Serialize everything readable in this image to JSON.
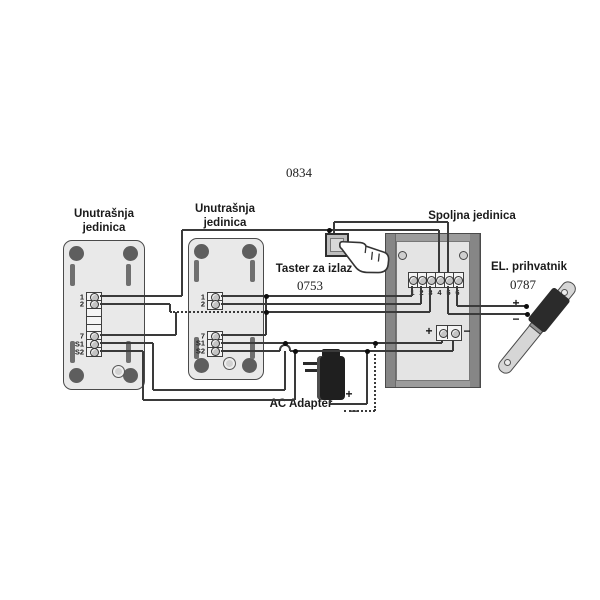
{
  "diagram": {
    "code_top": "0834",
    "indoor_unit_a": {
      "label_line1": "Unutrašnja",
      "label_line2": "jedinica",
      "terminals": [
        "1",
        "2",
        "7",
        "S1",
        "S2"
      ]
    },
    "indoor_unit_b": {
      "label_line1": "Unutrašnja",
      "label_line2": "jedinica",
      "terminals": [
        "1",
        "2",
        "7",
        "S1",
        "S2"
      ]
    },
    "outdoor_unit": {
      "label": "Spoljna jedinica",
      "terminals": [
        "1",
        "2",
        "3",
        "4",
        "5",
        "6"
      ],
      "power_plus": "+",
      "power_minus": "−"
    },
    "exit_button": {
      "label": "Taster za izlaz",
      "code": "0753"
    },
    "strike": {
      "label": "EL. prihvatnik",
      "code": "0787",
      "plus": "+",
      "minus": "−"
    },
    "adapter": {
      "label": "AC Adapter",
      "plus": "+",
      "minus": "−"
    }
  }
}
